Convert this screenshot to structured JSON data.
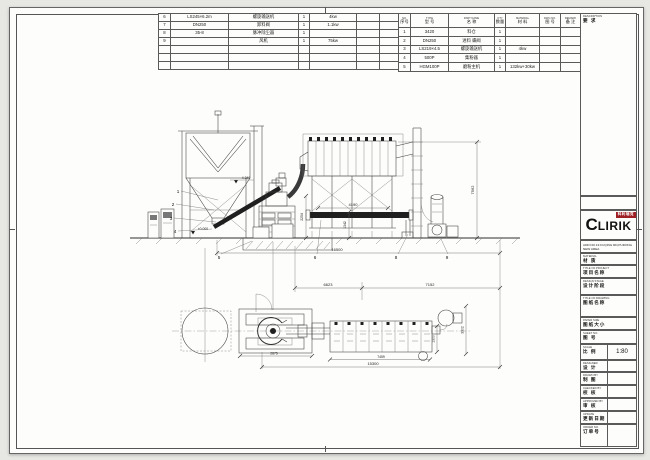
{
  "bom_left": {
    "rows": [
      {
        "no": "6",
        "model": "LS245×6.2m",
        "name": "螺旋输送机",
        "qty": "1",
        "power": "4kw"
      },
      {
        "no": "7",
        "model": "DN250",
        "name": "卸料阀",
        "qty": "1",
        "power": "1.1kw"
      },
      {
        "no": "8",
        "model": "35-8",
        "name": "脉冲除尘器",
        "qty": "1",
        "power": ""
      },
      {
        "no": "9",
        "model": "",
        "name": "风机",
        "qty": "1",
        "power": "75kw"
      }
    ]
  },
  "bom_right": {
    "headers": {
      "no": {
        "en": "NO.",
        "cn": "序号"
      },
      "model": {
        "en": "TYPE",
        "cn": "型 号"
      },
      "name": {
        "en": "PART NAME",
        "cn": "名 称"
      },
      "qty": {
        "en": "QTY",
        "cn": "数量"
      },
      "material": {
        "en": "MATERIAL",
        "cn": "材 料"
      },
      "dwg": {
        "en": "DWG NO.",
        "cn": "图 号"
      },
      "remark": {
        "en": "REMARK",
        "cn": "备 注"
      }
    },
    "rows": [
      {
        "no": "1",
        "model": "3420",
        "name": "料仓",
        "qty": "1",
        "material": "",
        "remark": ""
      },
      {
        "no": "2",
        "model": "DN250",
        "name": "进料 蝶阀",
        "qty": "1",
        "material": "",
        "remark": ""
      },
      {
        "no": "3",
        "model": "LS219×4.5",
        "name": "螺旋输送机",
        "qty": "1",
        "material": "4kw",
        "remark": ""
      },
      {
        "no": "4",
        "model": "500P",
        "name": "集粉器",
        "qty": "1",
        "material": "",
        "remark": ""
      },
      {
        "no": "5",
        "model": "HGM100P",
        "name": "磨粉主机",
        "qty": "1",
        "material": "132kw+30kw",
        "remark": ""
      }
    ]
  },
  "description_panel": {
    "en": "DESCRIPTION",
    "cn": "要 求"
  },
  "title_block": {
    "logo_text": "LIRIK",
    "logo_c": "C",
    "logo_badge": "科利瑞克",
    "address_line1": "ADD:NO.19 FUQING RD,PUDONG NEW AREA",
    "address_line2": "SHANGHAI CHINA  WWW.CLIRIK.COM",
    "material": {
      "en": "MATERIAL",
      "cn": "材 质"
    },
    "project": {
      "en": "TITLE OF PROJECT",
      "cn": "项目名称"
    },
    "stage": {
      "en": "DESIGN STAGE",
      "cn": "设计阶段"
    },
    "drawing": {
      "en": "TITLE OF DRAWING",
      "cn": "图纸名称"
    },
    "paper": {
      "en": "PAPER SIZE",
      "cn": "图纸大小"
    },
    "sheet_no": {
      "en": "SHEET NO.",
      "cn": "图 号"
    },
    "scale": {
      "en": "SCALE",
      "cn": "比 例",
      "value": "1:80"
    },
    "designer": {
      "en": "DESIGNER",
      "cn": "设 计"
    },
    "drawn": {
      "en": "DRAWN BY",
      "cn": "制 图"
    },
    "checked": {
      "en": "CHECKED BY",
      "cn": "校 核"
    },
    "approved": {
      "en": "APPROVED BY",
      "cn": "审 核"
    },
    "update": {
      "en": "UPDATE",
      "cn": "更新日期"
    },
    "order": {
      "en": "ORDER NO.",
      "cn": "订单号"
    }
  },
  "drawing": {
    "dims": {
      "ground_total": "16500",
      "height_right": "7562",
      "support_width": "4190",
      "conveyor_height": "1342",
      "platform_height": "2254",
      "plan_span_left": "6623",
      "plan_span_right": "7152",
      "collector_length": "7459",
      "plan_total": "15300",
      "mill_pad": "2875",
      "collector_width": "3302",
      "outlet_offset": "1300"
    },
    "levels": {
      "conveyor_top": "4.340",
      "ground": "±0.000"
    },
    "balloons": {
      "b1": "1",
      "b2": "2",
      "b3": "3",
      "b4": "4",
      "b5": "5",
      "b6": "6",
      "b8": "8",
      "b9": "9"
    }
  }
}
